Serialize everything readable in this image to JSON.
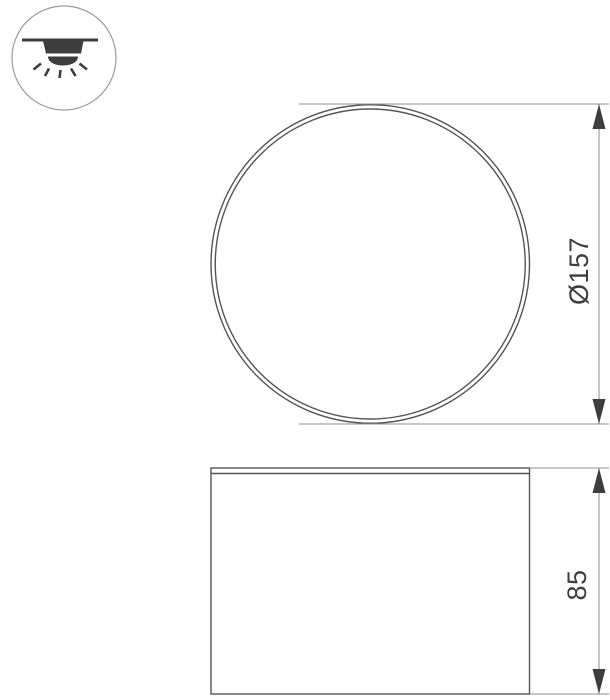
{
  "window": {
    "background": "#ffffff"
  },
  "mount_icon": {
    "name": "surface-mounted-downlight-icon",
    "glyph": "ceiling line with lamp housing, dome and downward light rays"
  },
  "top_view": {
    "dimension_label": "Ø157",
    "value": 157
  },
  "side_view": {
    "dimension_label": "85",
    "value": 85
  },
  "colors": {
    "background": "#ffffff",
    "outline": "#555555",
    "dimension_line": "#8e8e8e",
    "arrow": "#3e3e3e",
    "label_text": "#3e3e3e",
    "icon_glyph": "#3d3d3d",
    "icon_border": "#9c9c9c"
  }
}
